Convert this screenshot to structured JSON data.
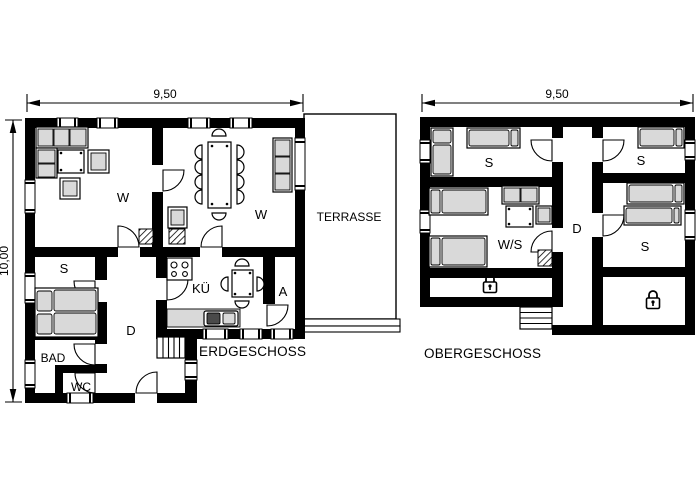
{
  "page": {
    "background": "#ffffff"
  },
  "colors": {
    "wall": "#000000",
    "furniture_fill": "#d9d9d9",
    "line": "#000000",
    "background": "#ffffff"
  },
  "icons": {
    "locked_room": "padlock-icon"
  },
  "erdgeschoss": {
    "title": "ERDGESCHOSS",
    "dim_width": "9,50",
    "dim_height": "10,00",
    "rooms": {
      "living": "W",
      "dining": "W",
      "bedroom": "S",
      "hall": "D",
      "bathroom": "BAD",
      "wc": "WC",
      "kitchen": "KÜ",
      "storage": "A",
      "terrace": "TERRASSE"
    }
  },
  "obergeschoss": {
    "title": "OBERGESCHOSS",
    "dim_width": "9,50",
    "rooms": {
      "bedroom_left": "S",
      "bedroom_right_top": "S",
      "living_sleeping": "W/S",
      "hall": "D",
      "bedroom_right_mid": "S"
    }
  }
}
